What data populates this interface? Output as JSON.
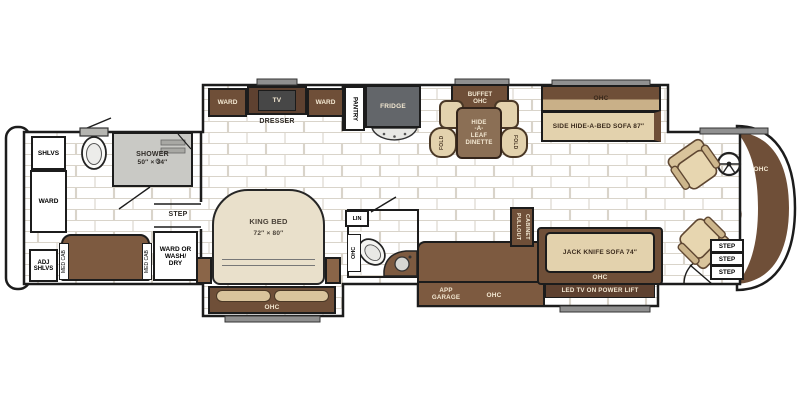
{
  "colors": {
    "outline": "#1c1c1c",
    "cabinet_brown": "#7d5a40",
    "dark_brown": "#6f4f38",
    "darker_brown": "#5e4130",
    "furniture_tan": "#e3d2ad",
    "shower_gray": "#c9c9c5",
    "fridge_gray": "#63666a",
    "cream_text": "#f3e8d2",
    "brick_mortar": "#d9d4ca"
  },
  "rear_bath": {
    "shlvs": "SHLVS",
    "ward": "WARD",
    "adj_shlvs": [
      "ADJ",
      "SHLVS"
    ],
    "shower_name": "SHOWER",
    "shower_size": "50″ × 34″",
    "step": "STEP",
    "ward_wash": [
      "WARD OR",
      "WASH/",
      "DRY"
    ],
    "med_cab": "MED CAB"
  },
  "bedroom": {
    "ward_left": "WARD",
    "tv": "TV",
    "ward_right": "WARD",
    "dresser": "DRESSER",
    "bed_name": "KING BED",
    "bed_size": "72″ × 80″",
    "ohc": "OHC"
  },
  "midship": {
    "pantry": "PANTRY",
    "fridge": "FRIDGE",
    "lin": "LIN",
    "bath_ohc": "OHC"
  },
  "dinette": {
    "buffet": "BUFFET",
    "buffet_ohc": "OHC",
    "table": [
      "HIDE",
      "-A-",
      "LEAF",
      "DINETTE"
    ],
    "fold": "FOLD"
  },
  "sofa": {
    "ohc": "OHC",
    "label": "SIDE HIDE-A-BED SOFA 87″"
  },
  "kitchen": {
    "app_garage": [
      "APP",
      "GARAGE"
    ],
    "ohc": "OHC",
    "pullout": "PULLOUT CABINET"
  },
  "living": {
    "sofa": "JACK KNIFE SOFA 74″",
    "ohc": "OHC",
    "tv_lift": "LED TV ON POWER LIFT"
  },
  "cockpit": {
    "ohc": "OHC",
    "steps": [
      "STEP",
      "STEP",
      "STEP"
    ]
  }
}
